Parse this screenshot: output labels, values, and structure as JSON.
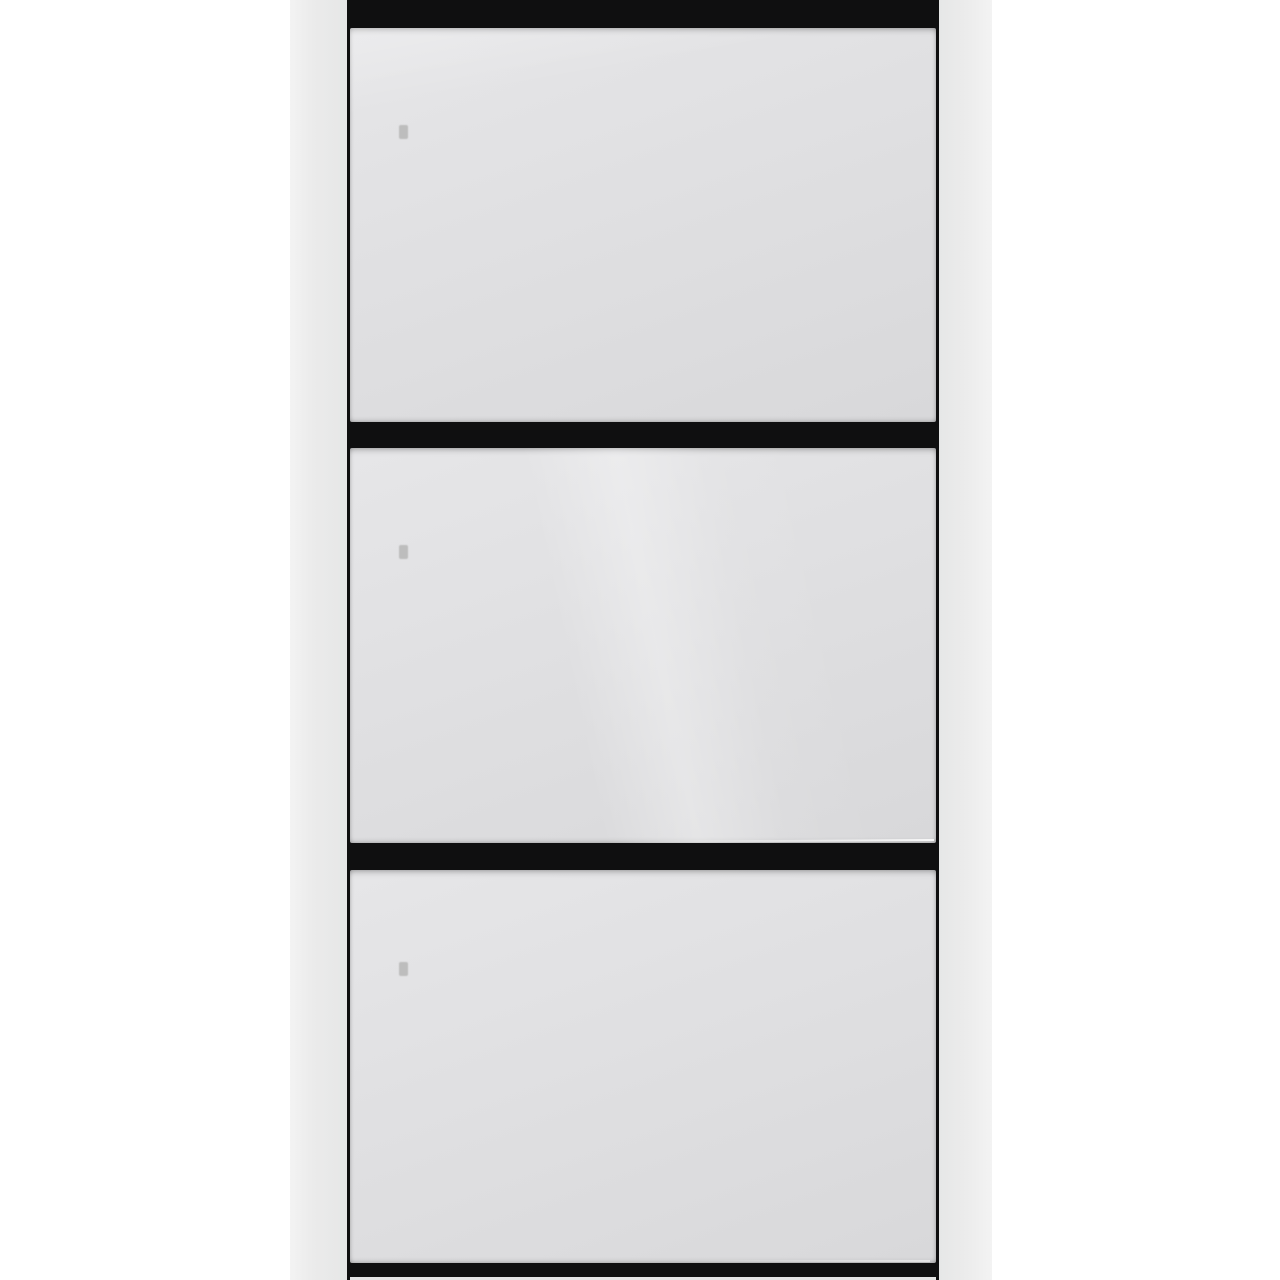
{
  "scene": {
    "type": "product-photo",
    "subject": "White shoe cabinet with three flip-down compartments and black recessed trim, photographed on a plain white background, bottom edge cropped"
  },
  "colors": {
    "background": "#ffffff",
    "side_panel_light": "#f3f3f3",
    "side_panel": "#ebebeb",
    "side_panel_dark": "#e6e7e7",
    "drawer_front_light": "#e6e6e8",
    "drawer_front": "#dfdfe1",
    "drawer_front_dark": "#d8d8da",
    "trim_black": "#0f0f10",
    "hinge_mark": "#bdbdbd",
    "base_strip": "#e4e4e4"
  },
  "cabinet": {
    "compartment_count": 3,
    "compartments": [
      {
        "id": "top",
        "label": "top flip compartment"
      },
      {
        "id": "middle",
        "label": "middle flip compartment"
      },
      {
        "id": "bottom",
        "label": "bottom flip compartment"
      }
    ]
  }
}
